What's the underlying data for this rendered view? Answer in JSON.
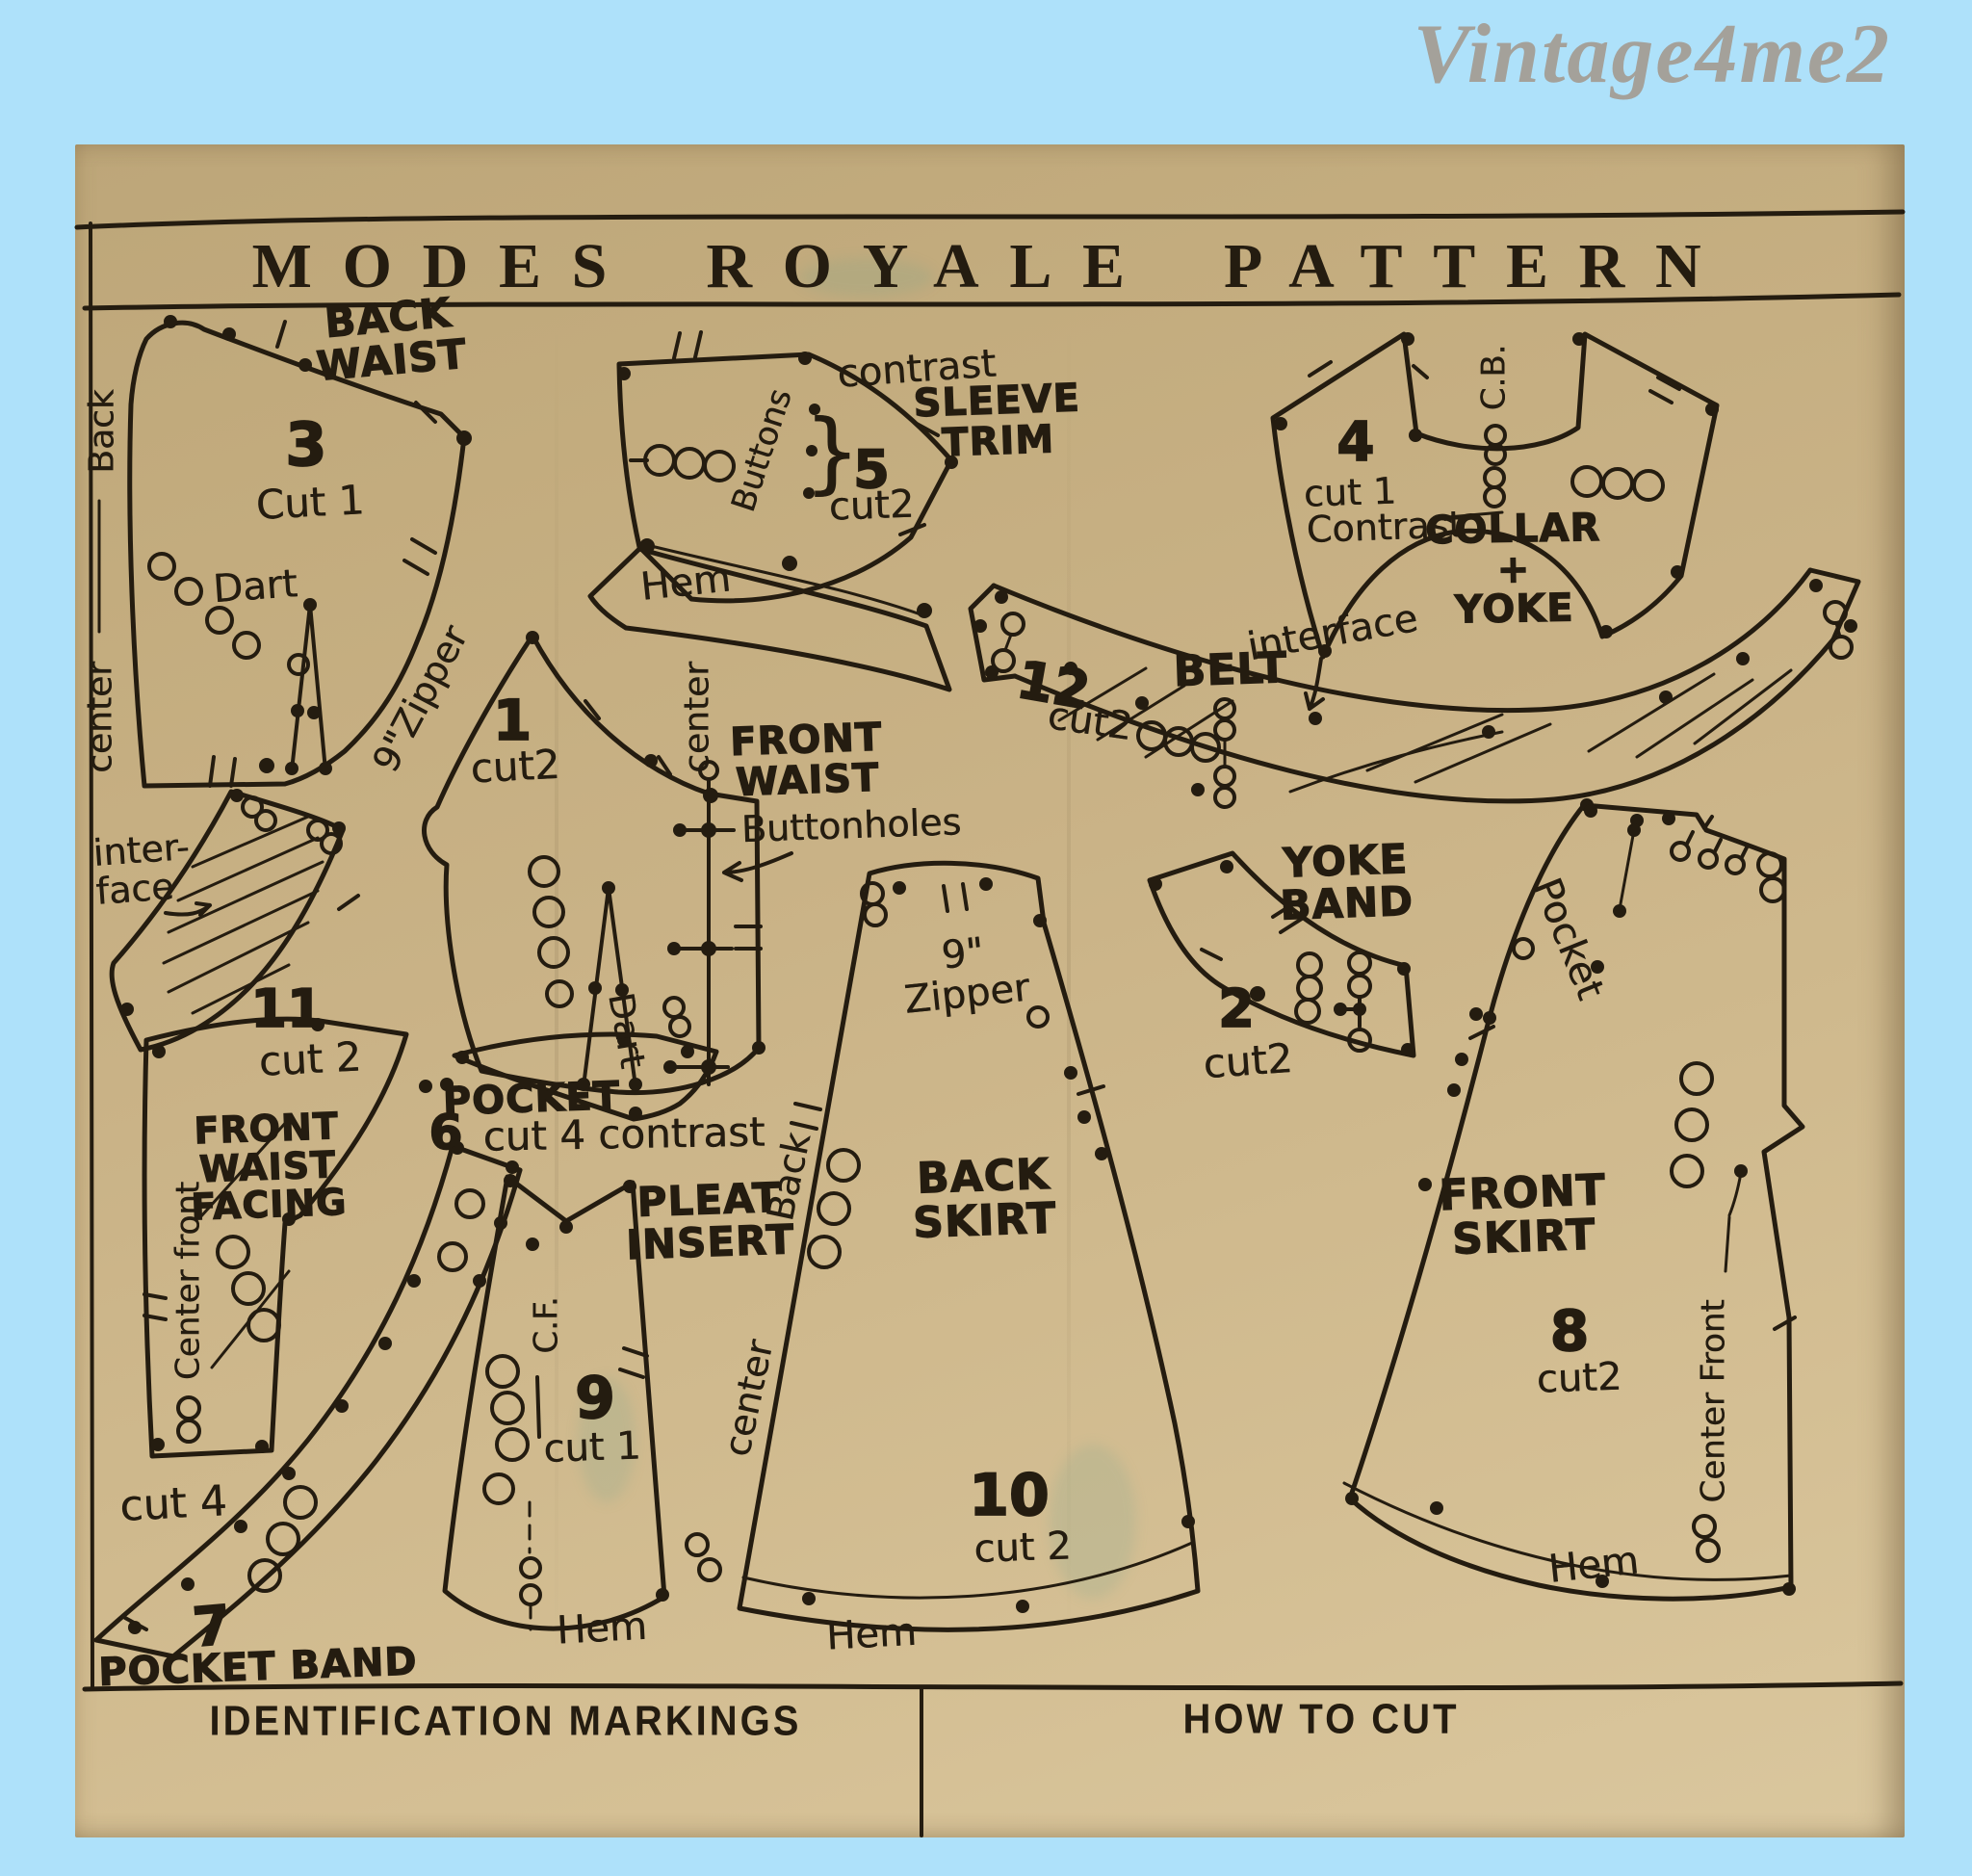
{
  "watermark": "Vintage4me2",
  "header": {
    "title": "MODES ROYALE PATTERN"
  },
  "footer": {
    "left_heading": "IDENTIFICATION MARKINGS",
    "right_heading": "HOW TO CUT"
  },
  "pieces": {
    "back_waist": {
      "title": "BACK\nWAIST",
      "number": "3",
      "cut": "Cut 1",
      "edge_top": "Back",
      "edge_bottom": "center",
      "dart": "Dart",
      "zipper": "9\"Zipper"
    },
    "front_waist": {
      "title": "FRONT\nWAIST",
      "number": "1",
      "cut": "cut2",
      "center": "center",
      "buttonholes": "Buttonholes",
      "dart": "Dart"
    },
    "sleeve_trim": {
      "title": "SLEEVE\nTRIM",
      "number": "5",
      "cut": "cut2",
      "contrast": "contrast",
      "buttons": "Buttons",
      "brace": "}",
      "hem": "Hem"
    },
    "collar_yoke": {
      "title": "COLLAR\n+\nYOKE",
      "number": "4",
      "cut": "cut 1",
      "contrast": "Contrast",
      "center_back": "C.B."
    },
    "belt": {
      "title": "BELT",
      "number": "12",
      "cut": "cut2",
      "interface": "interface"
    },
    "interfacing": {
      "label": "inter-\nface",
      "number": "11",
      "cut": "cut 2"
    },
    "front_waist_facing": {
      "title": "FRONT\nWAIST\nFACING",
      "center_front": "Center front"
    },
    "pocket": {
      "title": "POCKET",
      "number": "6",
      "cut": "cut 4  contrast"
    },
    "pocket_band": {
      "title": "POCKET BAND",
      "number": "7",
      "cut": "cut 4"
    },
    "pleat_insert": {
      "title": "PLEAT\nINSERT",
      "number": "9",
      "cut": "cut 1",
      "center_front": "C.F.",
      "hem": "Hem"
    },
    "back_skirt": {
      "title": "BACK\nSKIRT",
      "number": "10",
      "cut": "cut 2",
      "zipper": "9\"\nZipper",
      "edge_back": "Back",
      "edge_center": "center",
      "hem": "Hem"
    },
    "yoke_band": {
      "title": "YOKE\nBAND",
      "number": "2",
      "cut": "cut2"
    },
    "front_skirt": {
      "title": "FRONT\nSKIRT",
      "number": "8",
      "cut": "cut2",
      "pocket": "Pocket",
      "center_front": "Center Front",
      "hem": "Hem"
    }
  }
}
